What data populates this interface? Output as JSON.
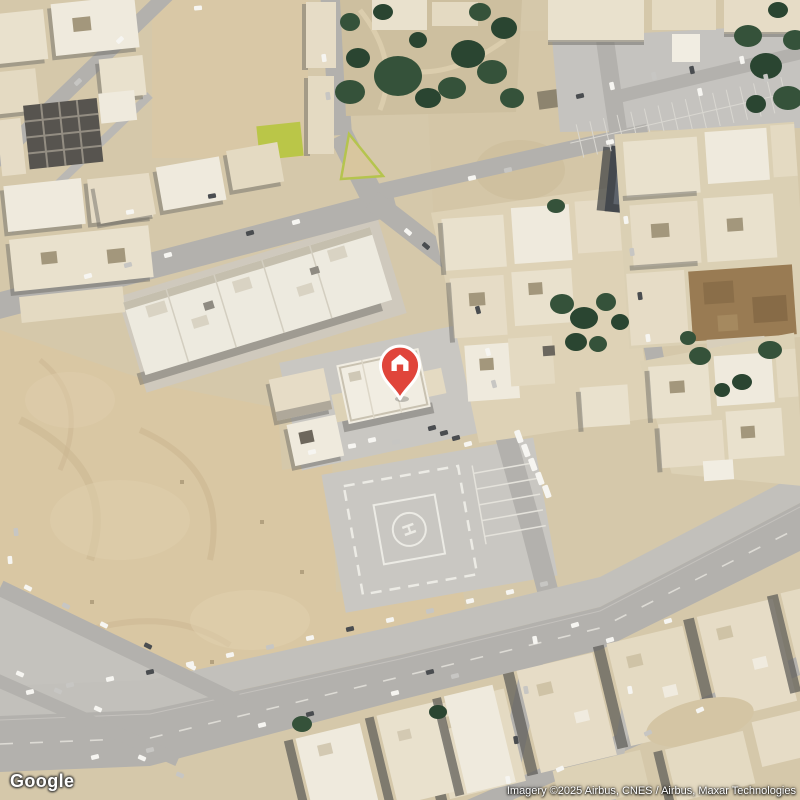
{
  "map": {
    "view_type": "satellite",
    "marker": {
      "type": "place-pin",
      "icon": "home",
      "color": "#e0453b"
    },
    "helipad_label": "H"
  },
  "footer": {
    "logo_text": "Google",
    "attribution_text": "Imagery ©2025 Airbus, CNES / Airbus, Maxar Technologies"
  },
  "colors": {
    "sand_base": "#d5c8aa",
    "empty_lot": "#d9c7a3",
    "road": "#b3b1ad",
    "pavement": "#c8c6c1",
    "building": "#e6dcc4",
    "tree_green": "#35523a",
    "grass_lime": "#b6c53e",
    "pool_blue": "#4ab6ca",
    "marker_red": "#e0453b"
  }
}
